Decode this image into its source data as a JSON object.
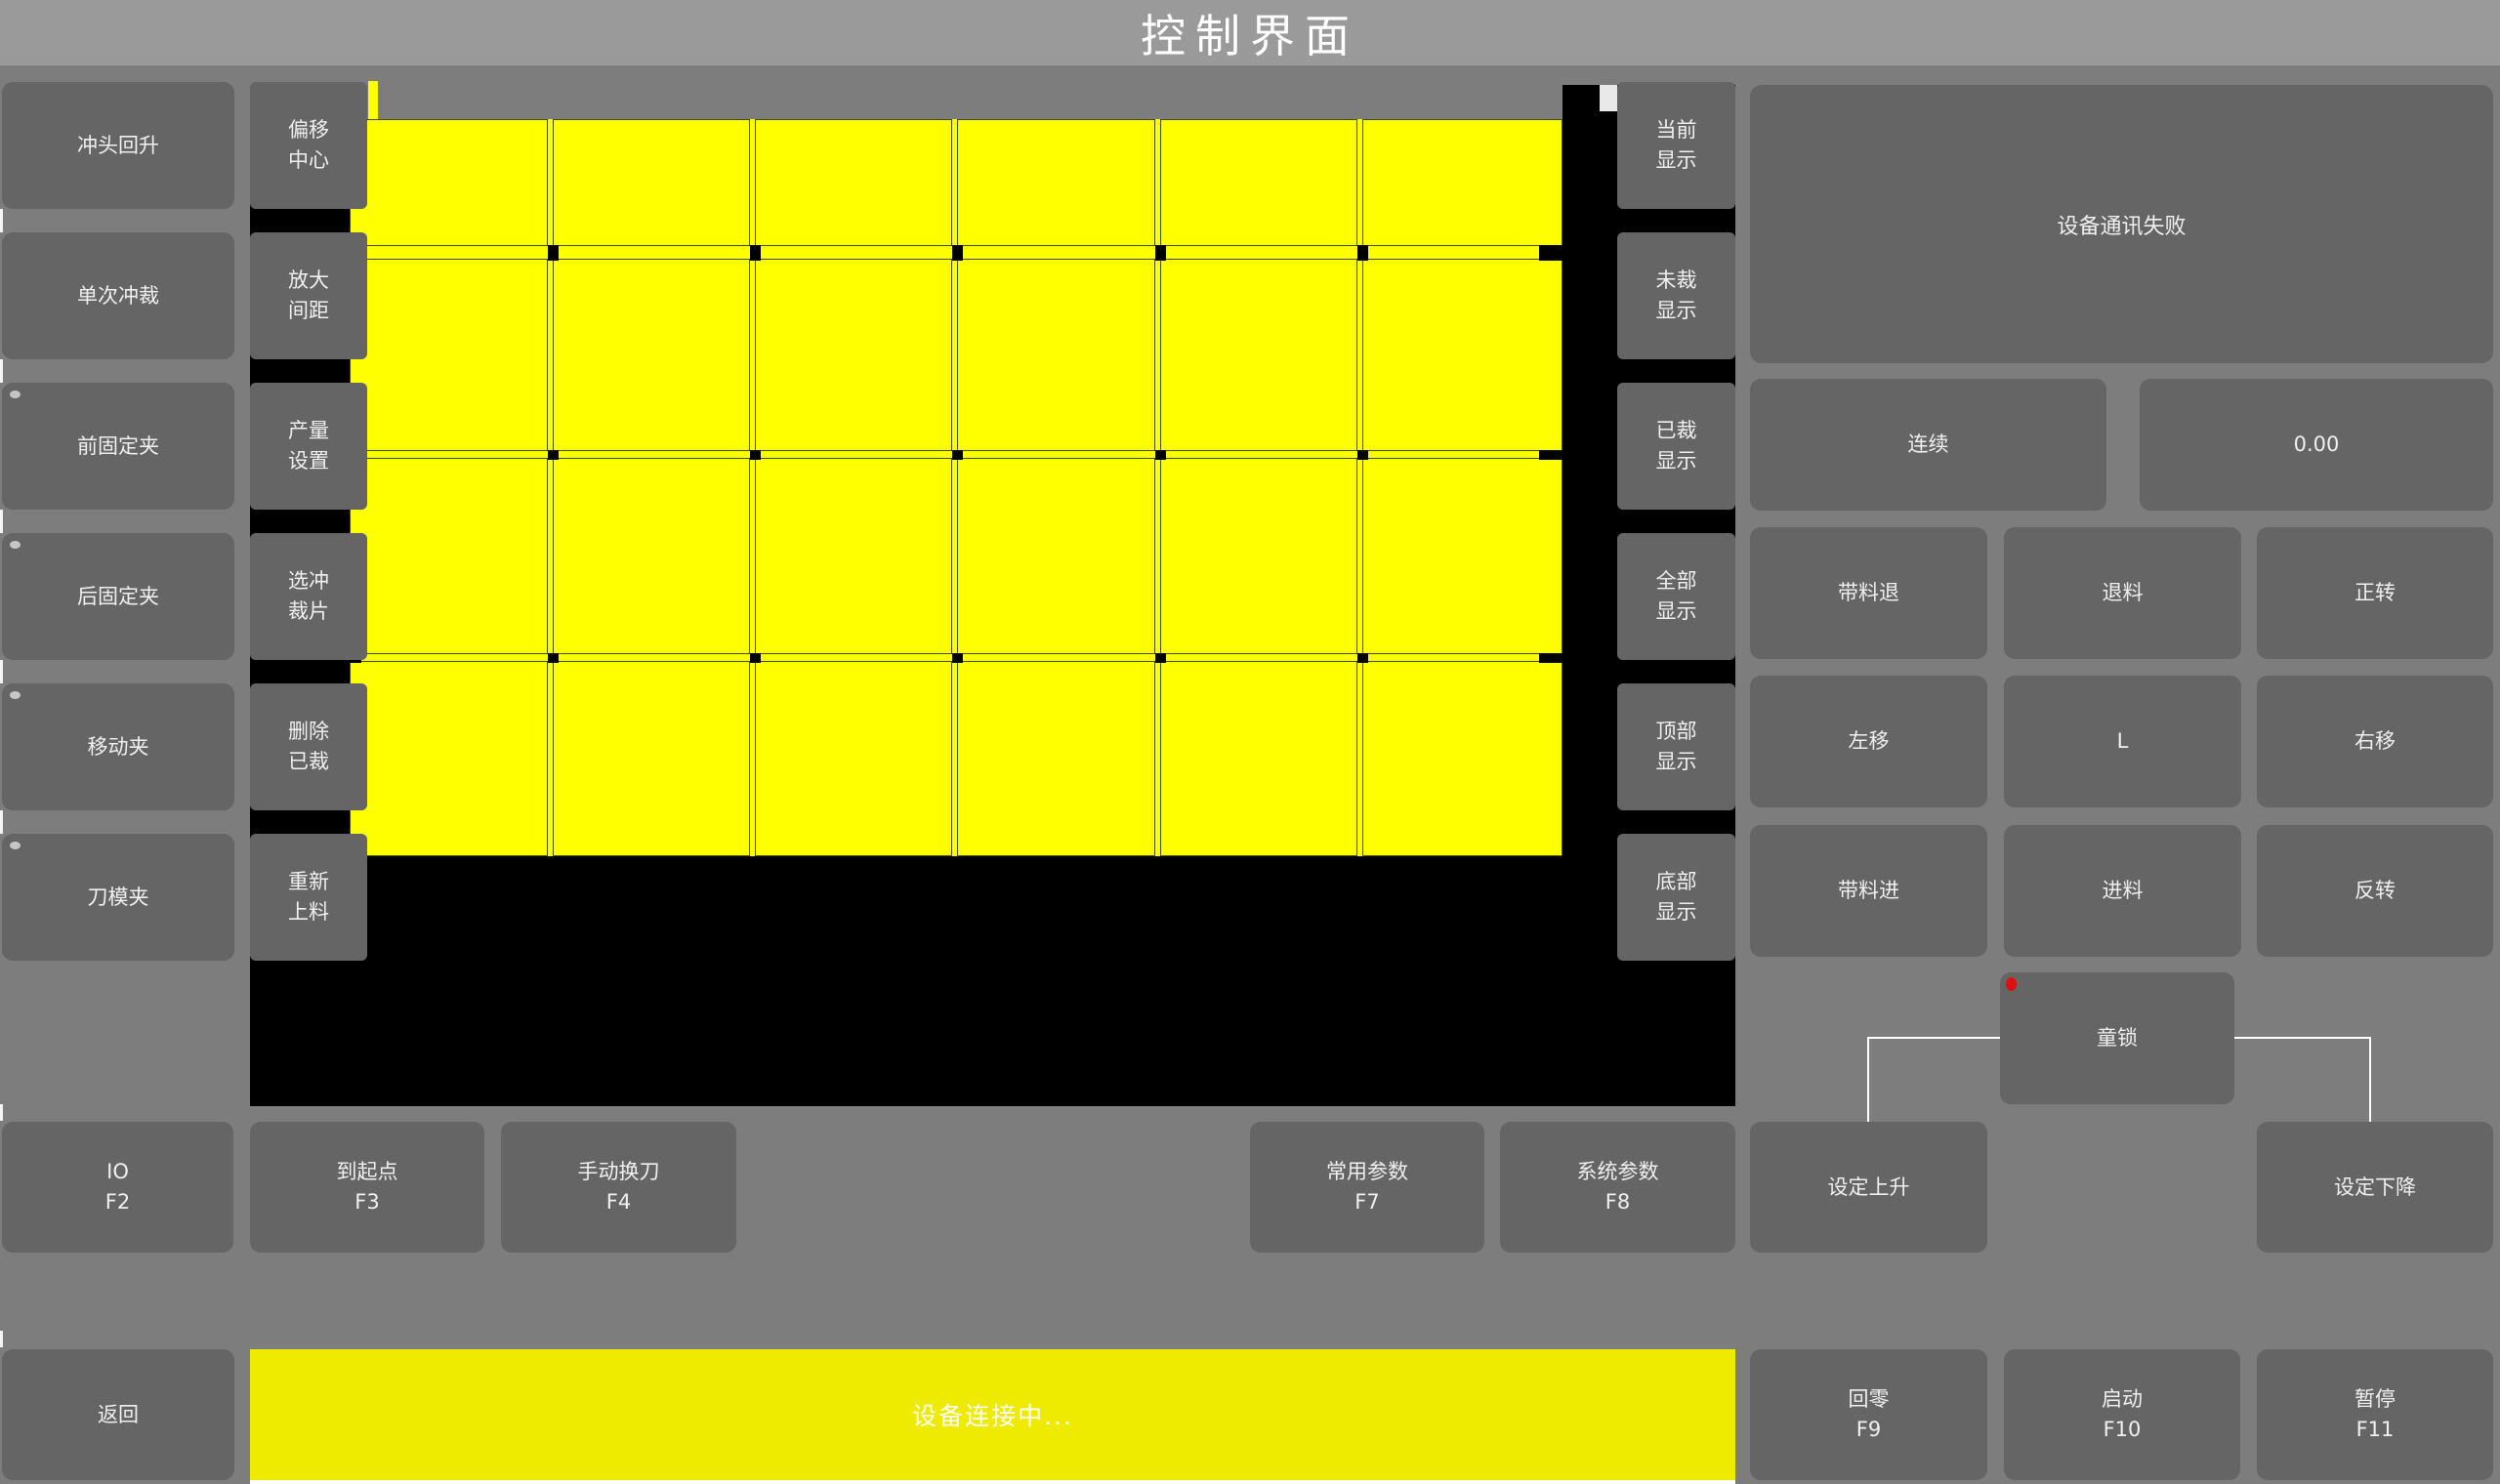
{
  "title_bar": {
    "title": "控制界面"
  },
  "left_sidebar": {
    "buttons": [
      {
        "label": "冲头回升",
        "indicator": false
      },
      {
        "label": "单次冲裁",
        "indicator": false
      },
      {
        "label": "前固定夹",
        "indicator": true
      },
      {
        "label": "后固定夹",
        "indicator": true
      },
      {
        "label": "移动夹",
        "indicator": true
      },
      {
        "label": "刀模夹",
        "indicator": true
      }
    ]
  },
  "tool_column": {
    "buttons": [
      {
        "line1": "偏移",
        "line2": "中心"
      },
      {
        "line1": "放大",
        "line2": "间距"
      },
      {
        "line1": "产量",
        "line2": "设置"
      },
      {
        "line1": "选冲",
        "line2": "裁片"
      },
      {
        "line1": "删除",
        "line2": "已裁"
      },
      {
        "line1": "重新",
        "line2": "上料"
      }
    ]
  },
  "display_column": {
    "buttons": [
      {
        "line1": "当前",
        "line2": "显示"
      },
      {
        "line1": "未裁",
        "line2": "显示"
      },
      {
        "line1": "已裁",
        "line2": "显示"
      },
      {
        "line1": "全部",
        "line2": "显示"
      },
      {
        "line1": "顶部",
        "line2": "显示"
      },
      {
        "line1": "底部",
        "line2": "显示"
      }
    ]
  },
  "canvas": {
    "pieces_rows": 4,
    "pieces_cols": 6
  },
  "right_panel": {
    "message": "设备通讯失败",
    "mode_button": "连续",
    "value_display": "0.00",
    "jog_grid": [
      {
        "label": "带料退"
      },
      {
        "label": "退料"
      },
      {
        "label": "正转"
      },
      {
        "label": "左移"
      },
      {
        "label": "L"
      },
      {
        "label": "右移"
      },
      {
        "label": "带料进"
      },
      {
        "label": "进料"
      },
      {
        "label": "反转"
      }
    ],
    "child_lock": {
      "label": "童锁"
    }
  },
  "function_row": [
    {
      "label": "IO",
      "fkey": "F2"
    },
    {
      "label": "到起点",
      "fkey": "F3"
    },
    {
      "label": "手动换刀",
      "fkey": "F4"
    },
    {
      "label": "常用参数",
      "fkey": "F7"
    },
    {
      "label": "系统参数",
      "fkey": "F8"
    },
    {
      "label": "设定上升",
      "fkey": ""
    },
    {
      "label": "设定下降",
      "fkey": ""
    }
  ],
  "bottom_bar": {
    "back": "返回",
    "status": "设备连接中...",
    "buttons": [
      {
        "label": "回零",
        "fkey": "F9"
      },
      {
        "label": "启动",
        "fkey": "F10"
      },
      {
        "label": "暂停",
        "fkey": "F11"
      }
    ]
  },
  "colors": {
    "background": "#7d7d7d",
    "title_bar": "#9a9a9a",
    "button": "#656565",
    "canvas_black": "#000000",
    "piece_yellow": "#ffff00",
    "piece_border": "#404e00",
    "status_yellow": "#eeea00",
    "alert_red": "#e01010",
    "text": "#f0f0f0",
    "connector_line": "#ffffff"
  }
}
